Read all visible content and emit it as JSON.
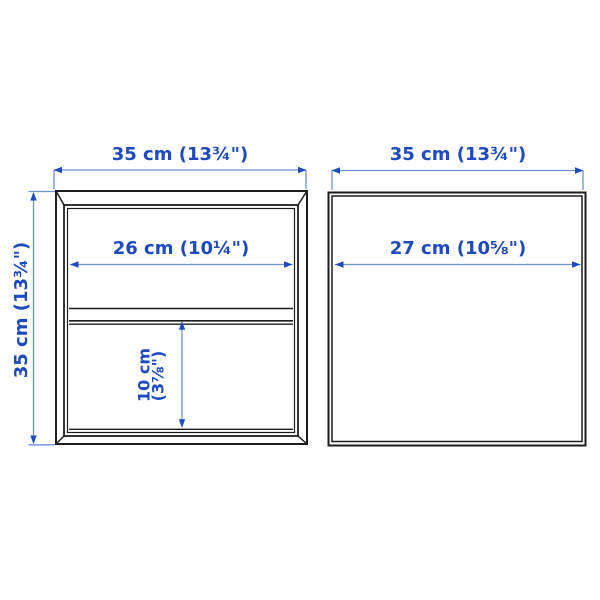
{
  "figures": {
    "left": "two-drawer-cabinet-front-view",
    "right": "open-cabinet-front-view"
  },
  "colors": {
    "outline": "#1d1d1d",
    "dimension_accent": "#1d4ac0",
    "dimension_line": "#6b93d6",
    "background": "#ffffff"
  },
  "dimensions": {
    "left_width": "35 cm (13¾\")",
    "left_height": "35 cm (13¾\")",
    "left_inner_width": "26 cm (10¼\")",
    "left_drawer_height_cm": "10 cm",
    "left_drawer_height_in": "(3⅞\")",
    "right_width": "35 cm (13¾\")",
    "right_inner_width": "27 cm (10⅝\")"
  }
}
